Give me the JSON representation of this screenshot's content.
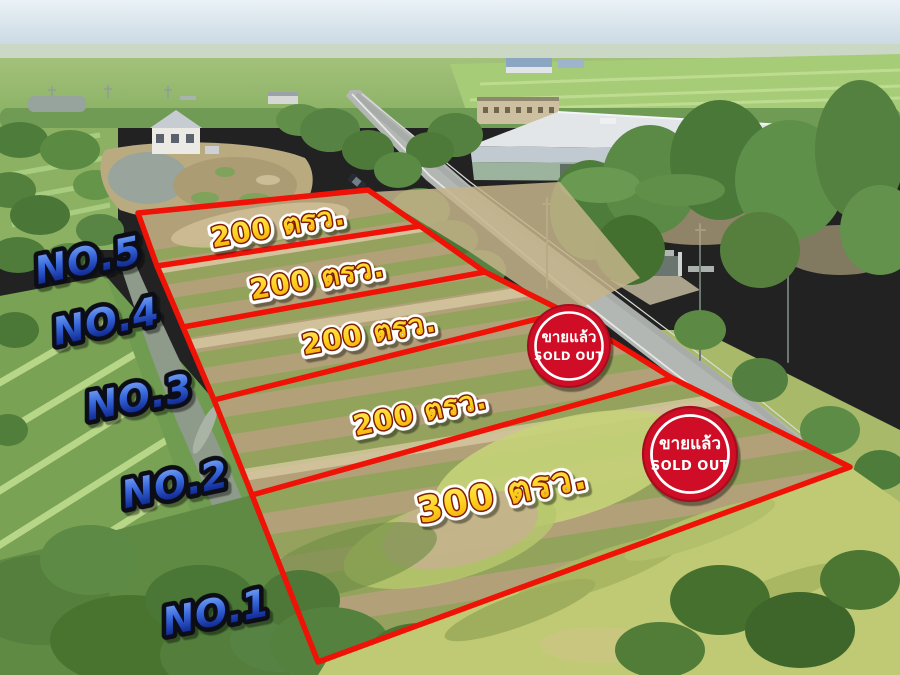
{
  "overlay": {
    "plots": [
      {
        "number": "NO.1",
        "size": "300 ตรว."
      },
      {
        "number": "NO.2",
        "size": "200 ตรว."
      },
      {
        "number": "NO.3",
        "size": "200 ตรว."
      },
      {
        "number": "NO.4",
        "size": "200 ตรว."
      },
      {
        "number": "NO.5",
        "size": "200 ตรว."
      }
    ],
    "sold_badges": [
      {
        "line1": "ขายแล้ว",
        "line2": "SOLD OUT"
      },
      {
        "line1": "ขายแล้ว",
        "line2": "SOLD OUT"
      }
    ]
  },
  "colors": {
    "plot_outline": "#ee1207",
    "badge_fill": "#cf1126",
    "badge_rim": "#a50d1c",
    "badge_ring": "#ffffff",
    "size_label_fill": "#ffd21e",
    "size_label_outline": "#7d1d04",
    "size_label_halo": "#ffffff",
    "number_label_fill": "#2e62d9",
    "number_label_outline": "#0a0c14"
  }
}
